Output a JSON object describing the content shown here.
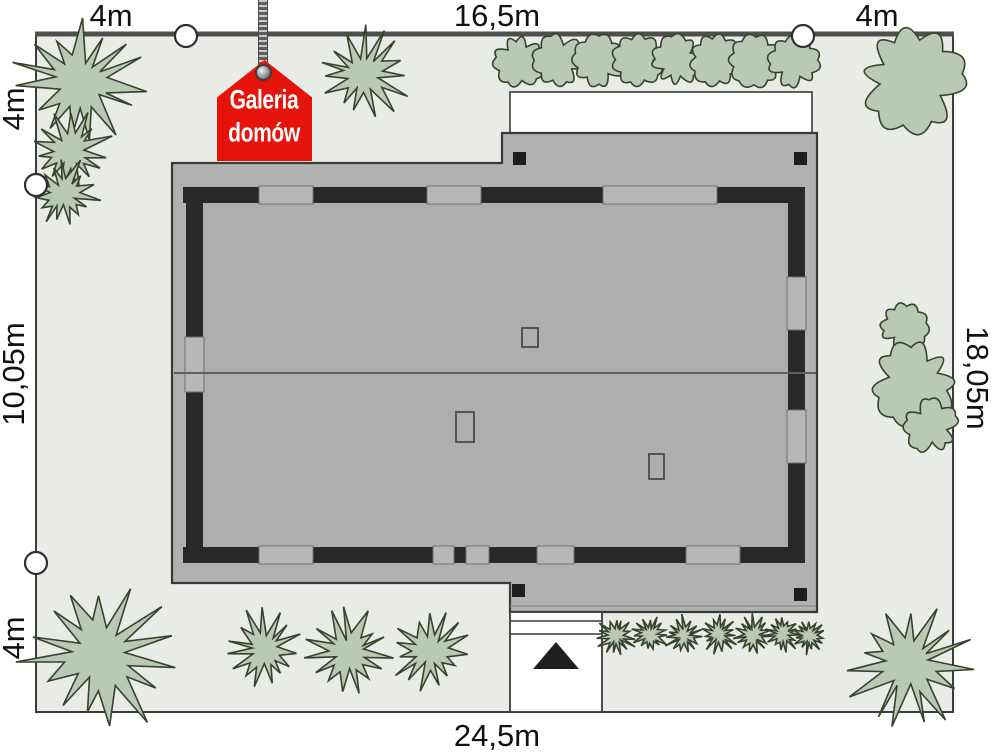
{
  "labels": {
    "top_left": "4m",
    "top_center": "16,5m",
    "top_right": "4m",
    "left_top": "4m",
    "left_middle": "10,05m",
    "left_bottom": "4m",
    "right_middle": "18,05m",
    "bottom_center": "24,5m"
  },
  "logo": {
    "line1": "Galeria",
    "line2": "domów",
    "red": "#e6130a"
  },
  "colors": {
    "page_bg": "#ffffff",
    "plot_fill": "#e9ebe7",
    "plot_border": "#3c3c3c",
    "street_edge": "#4e4e4e",
    "roof_fill": "#b1b1b1",
    "roof_border": "#3a3a3a",
    "interior_fill": "#aeaeae",
    "wall_fill": "#28282a",
    "window_fill": "#b7b7b7",
    "window_border": "#707070",
    "ridge": "#5f5f5f",
    "tree_fill": "#bac9b4",
    "tree_border": "#37422f",
    "marker_fill": "#ffffff",
    "marker_border": "#2e2e2e",
    "driveway_fill": "#ffffff",
    "driveway_border": "#3a3a3a",
    "arrow_fill": "#1f1f1f",
    "chimney_fill": "#1e1e1e"
  },
  "scene": {
    "plot": {
      "x": 36,
      "y": 33,
      "w": 917,
      "h": 679
    },
    "terrace": {
      "x": 510,
      "y": 92,
      "w": 302,
      "h": 41
    },
    "roof_points": "172,163 502,163 502,133 817,133 817,612 510,612 510,583 172,583",
    "interior": {
      "x": 203,
      "y": 203,
      "w": 585,
      "h": 344
    },
    "eave_line": {
      "x1": 510,
      "y1": 606,
      "x2": 816,
      "y2": 606
    },
    "ridge": {
      "x1": 174,
      "y1": 373,
      "x2": 816,
      "y2": 373
    },
    "walls": [
      {
        "x": 183,
        "y": 187,
        "w": 622,
        "h": 16
      },
      {
        "x": 183,
        "y": 547,
        "w": 622,
        "h": 16
      },
      {
        "x": 186,
        "y": 190,
        "w": 17,
        "h": 368
      },
      {
        "x": 788,
        "y": 190,
        "w": 17,
        "h": 368
      }
    ],
    "windows": [
      {
        "x": 259,
        "y": 186,
        "w": 54,
        "h": 18
      },
      {
        "x": 427,
        "y": 186,
        "w": 54,
        "h": 18
      },
      {
        "x": 603,
        "y": 186,
        "w": 114,
        "h": 18
      },
      {
        "x": 259,
        "y": 546,
        "w": 54,
        "h": 18
      },
      {
        "x": 433,
        "y": 546,
        "w": 21,
        "h": 18
      },
      {
        "x": 466,
        "y": 546,
        "w": 23,
        "h": 18
      },
      {
        "x": 537,
        "y": 546,
        "w": 37,
        "h": 18
      },
      {
        "x": 686,
        "y": 546,
        "w": 54,
        "h": 18
      },
      {
        "x": 185,
        "y": 337,
        "w": 19,
        "h": 55
      },
      {
        "x": 787,
        "y": 277,
        "w": 19,
        "h": 53
      },
      {
        "x": 787,
        "y": 410,
        "w": 19,
        "h": 53
      }
    ],
    "chimneys": [
      [
        513,
        152
      ],
      [
        794,
        152
      ],
      [
        512,
        584
      ],
      [
        794,
        588
      ]
    ],
    "skylights": [
      {
        "x": 522,
        "y": 328,
        "w": 16,
        "h": 19
      },
      {
        "x": 456,
        "y": 412,
        "w": 18,
        "h": 30
      },
      {
        "x": 649,
        "y": 454,
        "w": 15,
        "h": 25
      }
    ],
    "driveway": {
      "x": 510,
      "y": 612,
      "w": 92,
      "h": 100,
      "lines": [
        621,
        634
      ],
      "arrow": "556,642 533,669 579,669"
    },
    "trees": [
      {
        "t": "star",
        "x": 80,
        "y": 82,
        "r": 62
      },
      {
        "t": "star",
        "x": 70,
        "y": 152,
        "r": 40
      },
      {
        "t": "star",
        "x": 64,
        "y": 194,
        "r": 33
      },
      {
        "t": "star",
        "x": 363,
        "y": 74,
        "r": 46
      },
      {
        "t": "cloud",
        "x": 912,
        "y": 80,
        "r": 52
      },
      {
        "t": "cloud",
        "x": 904,
        "y": 327,
        "r": 23
      },
      {
        "t": "cloud",
        "x": 914,
        "y": 383,
        "r": 41
      },
      {
        "t": "cloud",
        "x": 931,
        "y": 426,
        "r": 26
      },
      {
        "t": "star",
        "x": 100,
        "y": 655,
        "r": 76
      },
      {
        "t": "star",
        "x": 264,
        "y": 650,
        "r": 38
      },
      {
        "t": "star",
        "x": 348,
        "y": 653,
        "r": 41
      },
      {
        "t": "star",
        "x": 430,
        "y": 652,
        "r": 37
      },
      {
        "t": "star",
        "x": 910,
        "y": 663,
        "r": 60
      }
    ],
    "top_hedge": [
      [
        519,
        61,
        25
      ],
      [
        559,
        60,
        25
      ],
      [
        599,
        61,
        25
      ],
      [
        638,
        60,
        25
      ],
      [
        677,
        61,
        25
      ],
      [
        716,
        60,
        25
      ],
      [
        755,
        61,
        25
      ],
      [
        794,
        62,
        25
      ]
    ],
    "bottom_hedge": [
      [
        616,
        636,
        19
      ],
      [
        650,
        634,
        18
      ],
      [
        684,
        636,
        19
      ],
      [
        719,
        634,
        18
      ],
      [
        753,
        635,
        19
      ],
      [
        783,
        634,
        17
      ],
      [
        809,
        636,
        17
      ]
    ],
    "markers": [
      [
        186,
        36
      ],
      [
        803,
        36
      ],
      [
        36,
        185
      ],
      [
        36,
        563
      ]
    ]
  }
}
